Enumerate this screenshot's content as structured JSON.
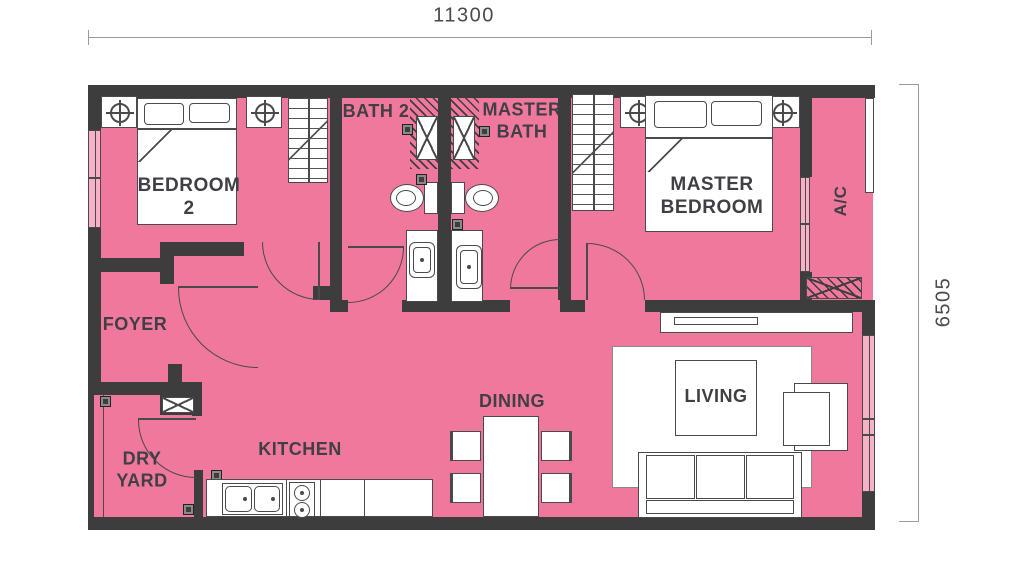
{
  "colors": {
    "floor_pink": "#F0789C",
    "window_pink": "#F6B1C6",
    "wall_dark": "#3D3D3D",
    "outline_gray": "#4A4A4A",
    "label_text": "#3F3F45",
    "dimension_gray": "#9A9A9A"
  },
  "dimensions": {
    "width_label": "11300",
    "height_label": "6505"
  },
  "rooms": {
    "bedroom2": {
      "line1": "BEDROOM",
      "line2": "2"
    },
    "bath2": {
      "name": "BATH 2"
    },
    "master_bath": {
      "line1": "MASTER",
      "line2": "BATH"
    },
    "master_bedroom": {
      "line1": "MASTER",
      "line2": "BEDROOM"
    },
    "ac_ledge": {
      "name": "A/C"
    },
    "foyer": {
      "name": "FOYER"
    },
    "dry_yard": {
      "line1": "DRY",
      "line2": "YARD"
    },
    "kitchen": {
      "name": "KITCHEN"
    },
    "dining": {
      "name": "DINING"
    },
    "living": {
      "name": "LIVING"
    }
  },
  "symbols": {
    "column_marker": "circle-crosshair",
    "floor_drain": "dark-square",
    "duct": "x-box",
    "shower": "hatched-box-with-x"
  }
}
